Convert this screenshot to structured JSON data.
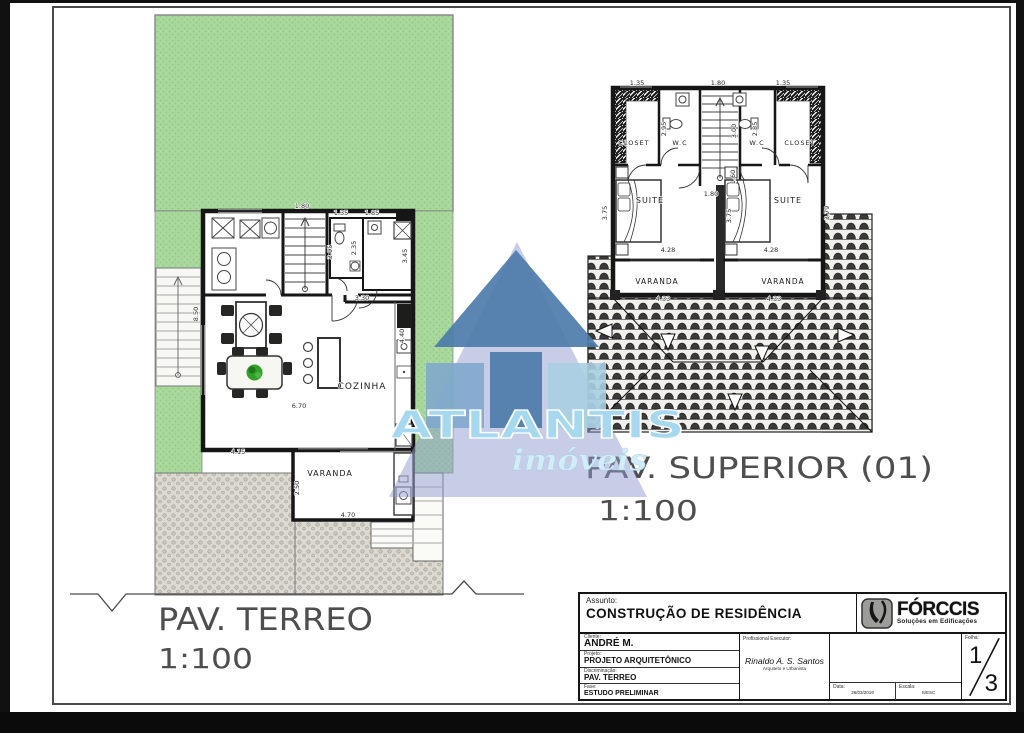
{
  "watermark": {
    "name": "ATLANTIS",
    "tagline": "imóveis"
  },
  "plans": {
    "ground": {
      "title": "PAV. TERREO",
      "scale": "1:100",
      "labels": {
        "cozinha": "COZINHA",
        "varanda": "VARANDA"
      },
      "dims": {
        "stair_w": "1.80",
        "stair_h": "3.05",
        "wc_w": "1.35",
        "annex_w": "1.85",
        "wc_h": "2.35",
        "annex_h": "3.45",
        "side_h": "8.50",
        "kitchen_w": "3.30",
        "kitchen_h": "4.40",
        "living_w": "6.70",
        "varanda_top": "4.15",
        "varanda_h": "2.50",
        "varanda_w": "4.70"
      }
    },
    "upper": {
      "title": "PAV. SUPERIOR (01)",
      "scale": "1:100",
      "labels": {
        "closet_l": "CLOSET",
        "wc_l": "W.C",
        "wc_r": "W.C",
        "closet_r": "CLOSET",
        "suite_l": "SUITE",
        "suite_r": "SUITE",
        "varanda_l": "VARANDA",
        "varanda_r": "VARANDA"
      },
      "dims": {
        "top_l": "1.35",
        "top_c": "1.80",
        "top_r": "1.35",
        "wc_l_h": "2.95",
        "stair_h": "3.00",
        "wc_r_h": "2.85",
        "hall_w": "1.80",
        "hall_h": "1.60",
        "suite_l_h": "3.75",
        "suite_c_h": "3.75",
        "suite_r_h": "3.79",
        "suite_l_w": "4.28",
        "suite_r_w": "4.28",
        "varanda_l_w": "4.33",
        "varanda_r_w": "4.33"
      }
    }
  },
  "titleblock": {
    "assunto_label": "Assunto:",
    "assunto": "CONSTRUÇÃO DE RESIDÊNCIA",
    "cliente_label": "Cliente:",
    "cliente": "ANDRÉ M.",
    "projeto_label": "Projeto:",
    "projeto": "PROJETO ARQUITETÔNICO",
    "discriminacao_label": "Discriminação:",
    "discriminacao": "PAV. TERREO",
    "fase_label": "Fase:",
    "fase": "ESTUDO PRELIMINAR",
    "executor_label": "Profissional Executor:",
    "executor": "Rinaldo A. S. Santos",
    "executor_title": "Arquiteto e Urbanista",
    "data_label": "Data:",
    "data": "26/03/2019",
    "escala_label": "Escala:",
    "escala": "S/ESC",
    "folha_label": "Folha:",
    "folha_num": "1",
    "folha_den": "3",
    "logo": {
      "name": "FÓRCCIS",
      "tagline": "Soluções em Edificações"
    }
  },
  "colors": {
    "garden_green": "#a9d89d",
    "watermark_blue": "#4d7cab",
    "watermark_light": "#a6d9f0",
    "wall_black": "#161616"
  }
}
